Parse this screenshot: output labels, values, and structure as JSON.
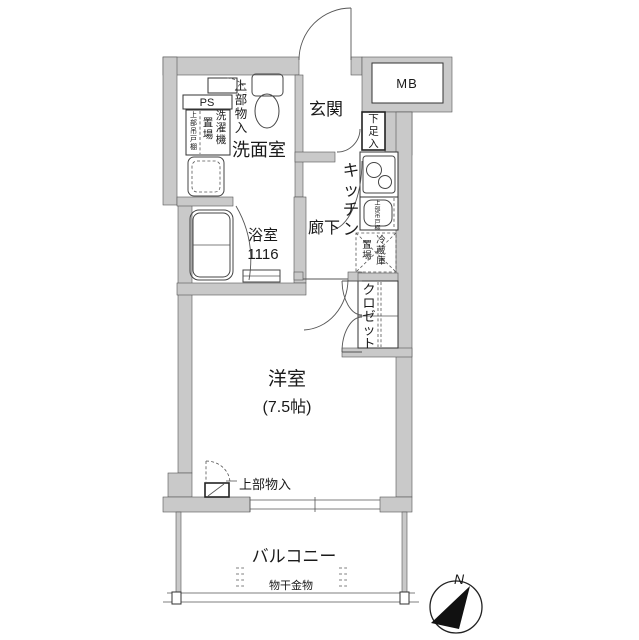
{
  "floorplan": {
    "colors": {
      "wall_fill": "#c9c9c9",
      "line": "#333333",
      "background": "#ffffff"
    },
    "labels": {
      "entrance": "玄関",
      "meter_box": "MB",
      "pipe_space": "PS",
      "shoe_cabinet": "下足入",
      "upper_storage_washroom": "上部物入",
      "washroom": "洗面室",
      "washer_place_right": "洗濯機",
      "washer_place_left": "置場",
      "washer_upper_cabinet": "上部吊戸棚",
      "bathroom": "浴室",
      "bathroom_size": "1116",
      "kitchen": "キッチン",
      "corridor": "廊下",
      "kitchen_upper_cabinet": "上部吊戸棚",
      "fridge_right": "冷蔵庫",
      "fridge_left": "置場",
      "closet": "クロゼット",
      "western_room": "洋室",
      "western_room_size": "(7.5帖)",
      "upper_storage_room": "上部物入",
      "balcony": "バルコニー",
      "laundry_hardware": "物干金物",
      "compass_north": "N"
    }
  }
}
